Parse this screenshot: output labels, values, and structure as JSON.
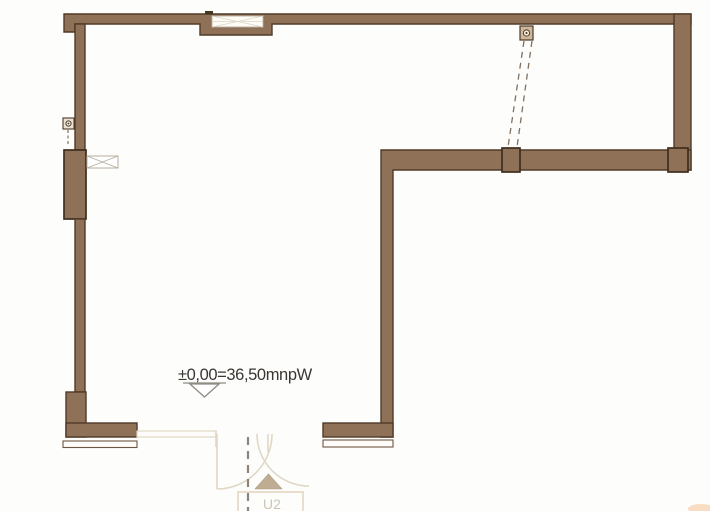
{
  "drawing": {
    "level_annotation": "±0,00=36,50mnpW",
    "door_label": "U2"
  },
  "colors": {
    "background": "#fdfdfb",
    "wall_fill": "#8e7156",
    "wall_outline": "#4f3b28",
    "pier_outline": "#3e2e1d",
    "threshold_outline": "#6d5540",
    "faint_line": "#e0d7c6",
    "dashed_trace": "#7f7060",
    "center_dash": "#8d857a",
    "lintel_outline": "#b7aea0",
    "level_marker": "#8f8b82",
    "text_color": "#3a3733",
    "door_triangle": "#bfad93",
    "u2_outline": "#e9ddce",
    "u2_text": "#cdc5b6",
    "smudge": "#f0a868"
  }
}
